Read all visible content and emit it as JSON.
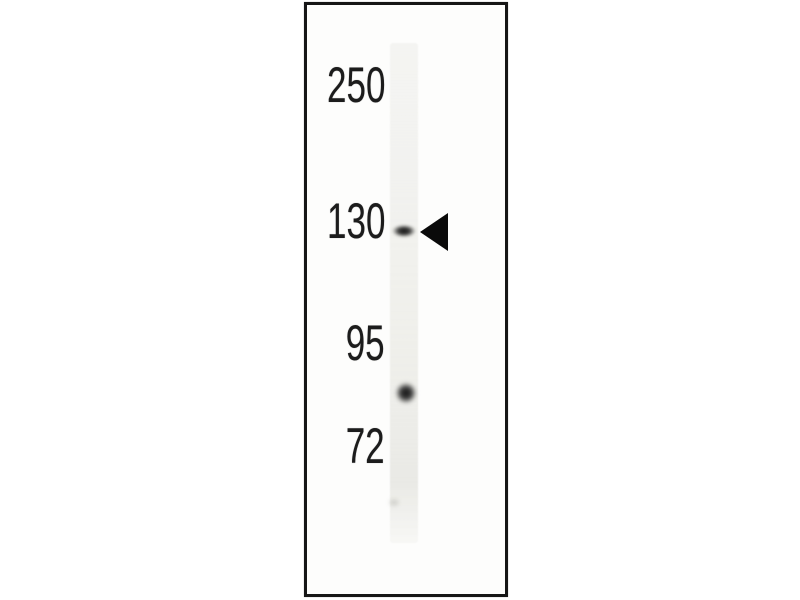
{
  "figure": {
    "description": "Western blot: single gel lane with molecular weight markers, one band at 130 kDa indicated by an arrowhead and one round band between 95 and 72 kDa",
    "colors": {
      "page_background": "#ffffff",
      "frame_background": "#fdfdfc",
      "frame_border": "#161616",
      "lane": "#f0f0ee",
      "label_text": "#1c1c1c",
      "band": "#1a1a1a",
      "arrow": "#0a0a0a"
    },
    "markers": [
      {
        "label": "250",
        "center_y": 85
      },
      {
        "label": "130",
        "center_y": 221
      },
      {
        "label": "95",
        "center_y": 343
      },
      {
        "label": "72",
        "center_y": 446
      }
    ],
    "bands": [
      {
        "position": "at 130 marker",
        "center_x": 404,
        "center_y": 231,
        "width": 26,
        "height": 14,
        "intensity": "strong"
      },
      {
        "position": "between 95 and 72",
        "center_x": 406,
        "center_y": 393,
        "width": 24,
        "height": 24,
        "intensity": "strong"
      },
      {
        "position": "below 72",
        "center_x": 394,
        "center_y": 502,
        "width": 14,
        "height": 11,
        "intensity": "very faint"
      }
    ],
    "arrow": {
      "direction": "left",
      "tip_x": 420,
      "center_y": 232,
      "width": 28,
      "height": 39,
      "points_to": "130"
    }
  }
}
